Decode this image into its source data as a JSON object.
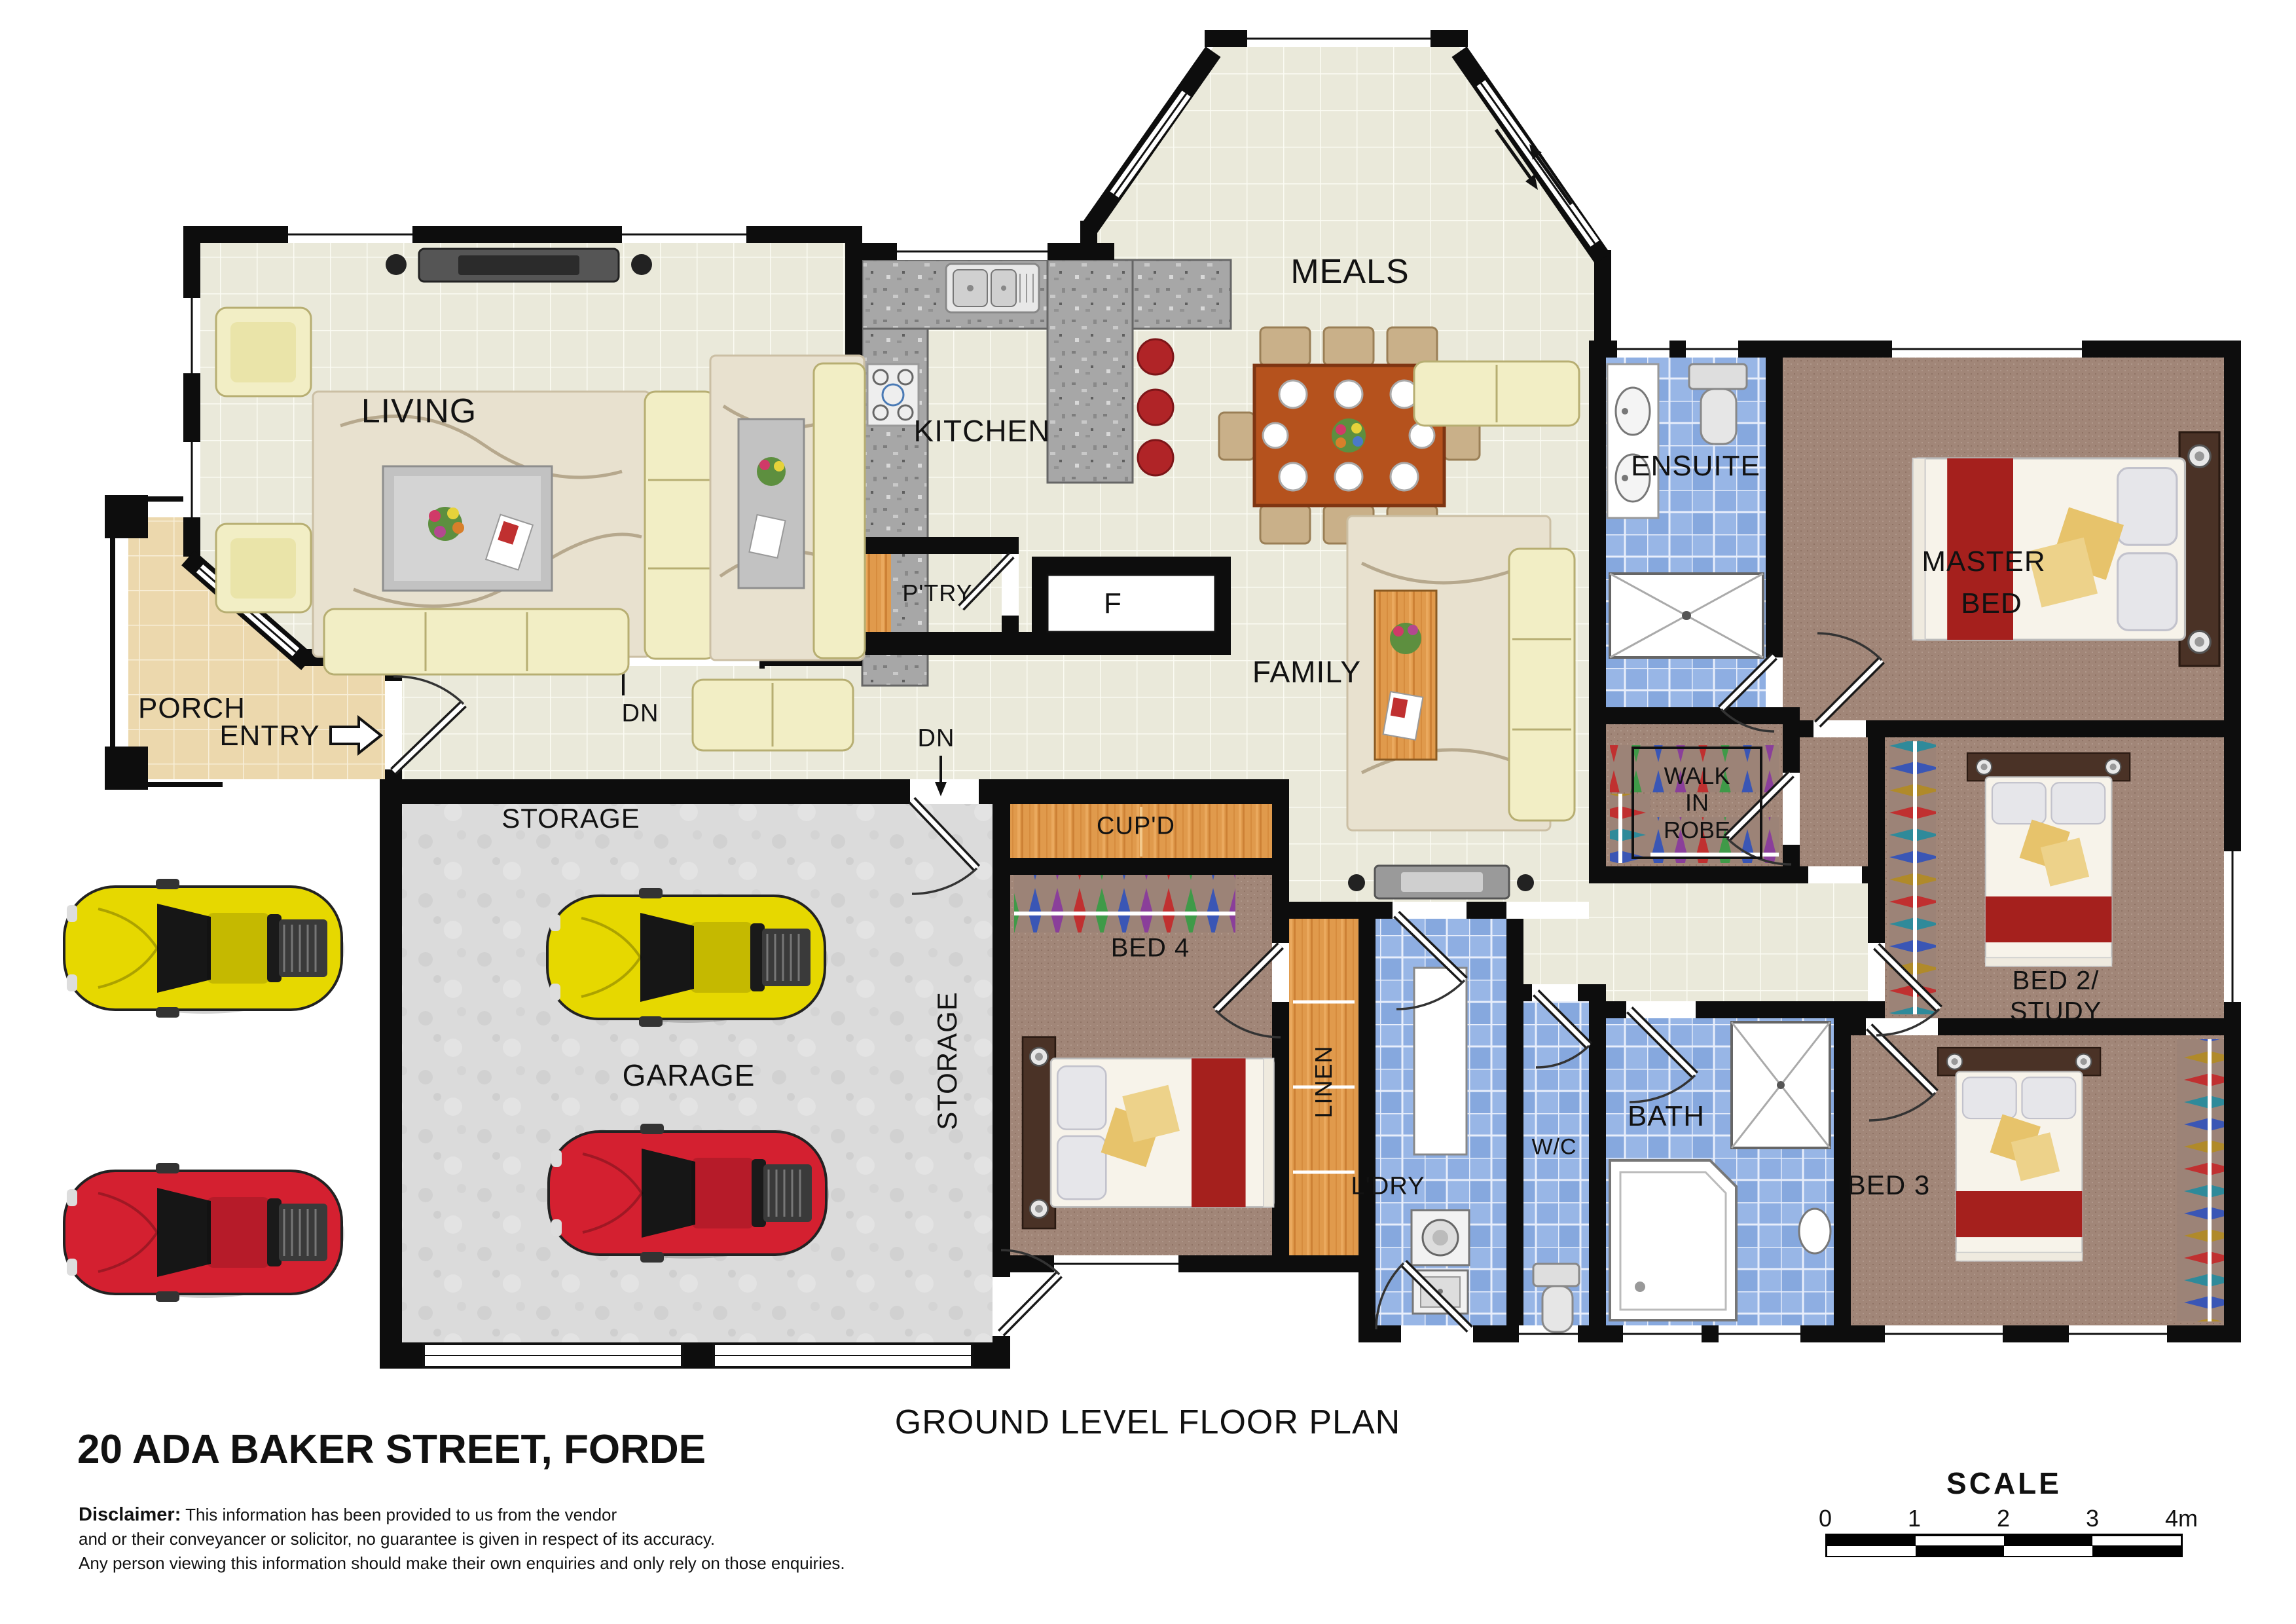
{
  "meta": {
    "address": "20 ADA BAKER STREET, FORDE",
    "plan_title": "GROUND LEVEL FLOOR PLAN",
    "disclaimer_label": "Disclaimer:",
    "disclaimer_lines": [
      "This information has been provided to us from the vendor",
      "and or their conveyancer or solicitor, no guarantee is given in respect of its accuracy.",
      "Any person viewing this information should make their own enquiries and only rely on those enquiries."
    ]
  },
  "scale_bar": {
    "title": "SCALE",
    "ticks": [
      "0",
      "1",
      "2",
      "3",
      "4m"
    ]
  },
  "rooms": {
    "living": "LIVING",
    "kitchen": "KITCHEN",
    "meals": "MEALS",
    "family": "FAMILY",
    "pantry": "P'TRY",
    "fridge": "F",
    "cupboard": "CUP'D",
    "porch": "PORCH",
    "entry": "ENTRY",
    "down": "DN",
    "storage_top": "STORAGE",
    "storage_side": "STORAGE",
    "garage": "GARAGE",
    "bed4": "BED 4",
    "linen": "LINEN",
    "laundry": "L'DRY",
    "wc": "W/C",
    "bath": "BATH",
    "bed3": "BED 3",
    "bed2_line1": "BED 2/",
    "bed2_line2": "STUDY",
    "walk_in_robe_lines": [
      "WALK",
      "IN",
      "ROBE"
    ],
    "ensuite": "ENSUITE",
    "master_line1": "MASTER",
    "master_line2": "BED"
  },
  "colors": {
    "wall": "#0d0d0d",
    "floor_tile_cream": "#eae9da",
    "floor_tile_tan": "#ecd8ad",
    "floor_tile_blue": "#98b6e6",
    "carpet_brown": "#a18678",
    "garage_concrete": "#dbdbdb",
    "granite_grey": "#a7a7a7",
    "wood_orange": "#e09a4c",
    "car_yellow": "#e6d800",
    "car_red": "#d42030",
    "bed_runner_red": "#a5201d",
    "sofa_cream": "#f2eec5"
  }
}
